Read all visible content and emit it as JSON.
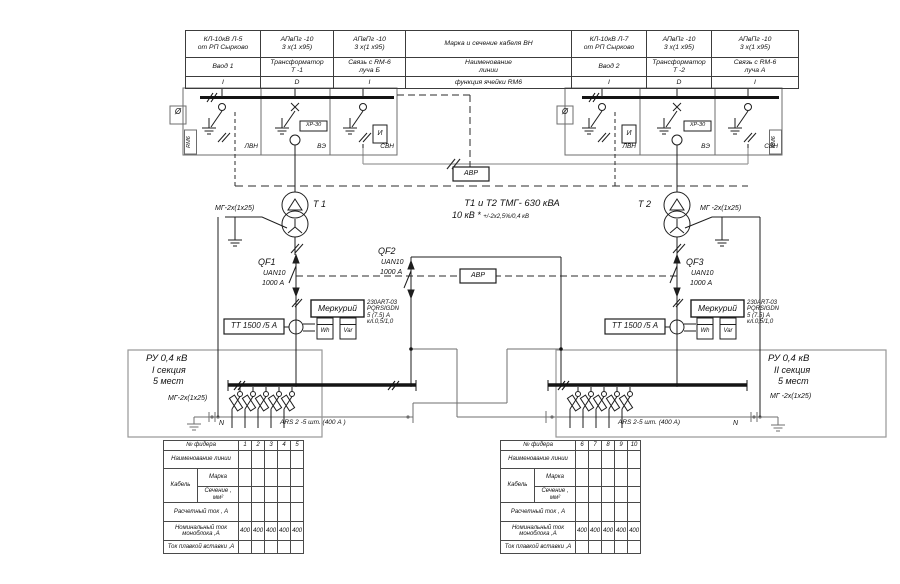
{
  "header": {
    "cols": [
      {
        "cable": [
          "КЛ-10кВ Л-5",
          "от РП Сырково"
        ],
        "line": [
          "Ввод 1",
          ""
        ],
        "func": "I"
      },
      {
        "cable": [
          "АПвПг -10",
          "3 х(1 х95)"
        ],
        "line": [
          "Трансформатор",
          "Т -1"
        ],
        "func": "D"
      },
      {
        "cable": [
          "АПвПг -10",
          "3 х(1 х95)"
        ],
        "line": [
          "Связь с RM-6",
          "луча Б"
        ],
        "func": "I"
      },
      {
        "cable": [
          "Марка и сечение кабеля  ВН",
          ""
        ],
        "line": [
          "Наименование",
          "линии"
        ],
        "func": "функция ячейки RM6"
      },
      {
        "cable": [
          "КЛ-10кВ Л-7",
          "от РП Сырково"
        ],
        "line": [
          "Ввод 2",
          ""
        ],
        "func": "I"
      },
      {
        "cable": [
          "АПвПг -10",
          "3 х(1 х95)"
        ],
        "line": [
          "Трансформатор",
          "Т -2"
        ],
        "func": "D"
      },
      {
        "cable": [
          "АПвПг -10",
          "3 х(1 х95)"
        ],
        "line": [
          "Связь с RM-6",
          "луча А"
        ],
        "func": "I"
      }
    ]
  },
  "rm6": {
    "unit_label": "RM6",
    "gauge_glyph": "Ø",
    "i_box": "И",
    "fuse_box": "ХР-30",
    "cell_lvn": "ЛВН",
    "cell_ve": "ВЭ",
    "cell_svn": "СВН"
  },
  "avr": {
    "label": "АВР"
  },
  "transformers": {
    "t1": "Т 1",
    "t2": "Т 2",
    "title": "Т1 и Т2   ТМГ- 630 кВА",
    "voltage_main": "10 кВ *",
    "voltage_note": "+/-2х2,5%/0,4  кВ",
    "ground_cable_t1": "МГ-2х(1х25)",
    "ground_cable_t2": "МГ -2х(1х25)"
  },
  "breakers": {
    "qf1": {
      "name": "QF1",
      "type": "UAN10",
      "current": "1000 А"
    },
    "qf2": {
      "name": "QF2",
      "type": "UAN10",
      "current": "1000 А"
    },
    "qf3": {
      "name": "QF3",
      "type": "UAN10",
      "current": "1000 А"
    }
  },
  "metering": {
    "ct_left": "ТТ 1500 /5 А",
    "ct_right": "ТТ 1500 /5 А",
    "meter": "Меркурий",
    "spec": [
      "230ART-03",
      "PQRSIGDN",
      "5 (7.5) А",
      "кл.0,5/1,0"
    ],
    "wh": "Wh",
    "var": "Var"
  },
  "switchboards": {
    "left": {
      "title": "РУ 0,4 кВ",
      "section": "I секция",
      "places": "5 мест",
      "ground_cable": "МГ-2х(1х25)",
      "neutral": "N",
      "fuse_label": "ARS 2 -5 шт. (400 А )"
    },
    "right": {
      "title": "РУ 0,4 кВ",
      "section": "II секция",
      "places": "5 мест",
      "ground_cable": "МГ -2х(1х25)",
      "neutral": "N",
      "fuse_label": "ARS 2-5 шт. (400 А)"
    }
  },
  "feeder_tables": {
    "labels": {
      "feeder_no": "№ фидера",
      "line_name": "Наименование линии",
      "cable": "Кабель",
      "brand": "Марка",
      "section": "Сечение , мм²",
      "calc": "Расчетный ток , А",
      "nominal": "Номинальный ток моноблока ,А",
      "fuse": "Ток плавкой вставки ,А"
    },
    "left": {
      "numbers": [
        "1",
        "2",
        "3",
        "4",
        "5"
      ],
      "nominal": [
        "400",
        "400",
        "400",
        "400",
        "400"
      ]
    },
    "right": {
      "numbers": [
        "6",
        "7",
        "8",
        "9",
        "10"
      ],
      "nominal": [
        "400",
        "400",
        "400",
        "400",
        "400"
      ]
    }
  }
}
